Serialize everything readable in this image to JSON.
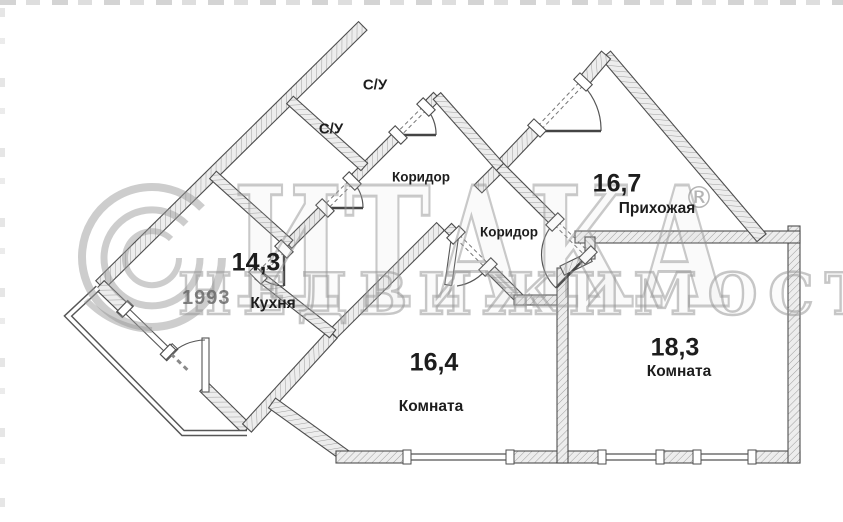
{
  "watermark": {
    "brand": "ИТАКА",
    "registered": "®",
    "subtitle": "НЕДВИЖИМОСТЬ",
    "year": "1993"
  },
  "rooms": {
    "wc_top": {
      "label": "С/У"
    },
    "wc_bottom": {
      "label": "С/У"
    },
    "corridor_top": {
      "label": "Коридор"
    },
    "corridor_bottom": {
      "label": "Коридор"
    },
    "hallway": {
      "area": "16,7",
      "label": "Прихожая"
    },
    "kitchen": {
      "area": "14,3",
      "label": "Кухня"
    },
    "room_center": {
      "area": "16,4",
      "label": "Комната"
    },
    "room_right": {
      "area": "18,3",
      "label": "Комната"
    }
  }
}
